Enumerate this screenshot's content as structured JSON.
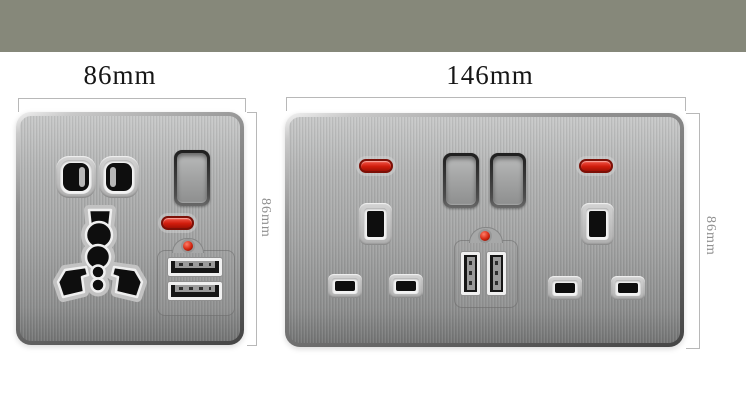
{
  "image": {
    "background_color": "#ffffff",
    "banner_color": "#86887a"
  },
  "palette": {
    "plate_metal": "#a7a8a8",
    "plate_edge_dark": "#4a4a4a",
    "neon_red": "#d6220e",
    "led_dot_red": "#c8260f",
    "usb_frame_white": "#f0f0f0",
    "socket_hole_black": "#0e0e0e",
    "dimension_line_gray": "#b8b8b8",
    "width_label_color": "#161616",
    "height_label_color": "#8f8f8f"
  },
  "left_socket": {
    "width_label": "86mm",
    "height_label": "86mm",
    "components": {
      "pin_holes": "universal-two-pin-holes",
      "multi_socket": "universal-three-pin-socket",
      "switch": "rocker-switch",
      "neon": "red-neon-indicator",
      "led": "red-led-dot",
      "usb": "dual-usb-a-ports-horizontal"
    }
  },
  "right_socket": {
    "width_label": "146mm",
    "height_label": "86mm",
    "components": {
      "neon_left": "red-neon-indicator",
      "neon_right": "red-neon-indicator",
      "switch_left": "rocker-switch",
      "switch_right": "rocker-switch",
      "uk_socket_left": "uk-three-pin-socket",
      "uk_socket_right": "uk-three-pin-socket",
      "led": "red-led-dot",
      "usb": "dual-usb-a-ports-vertical"
    }
  }
}
